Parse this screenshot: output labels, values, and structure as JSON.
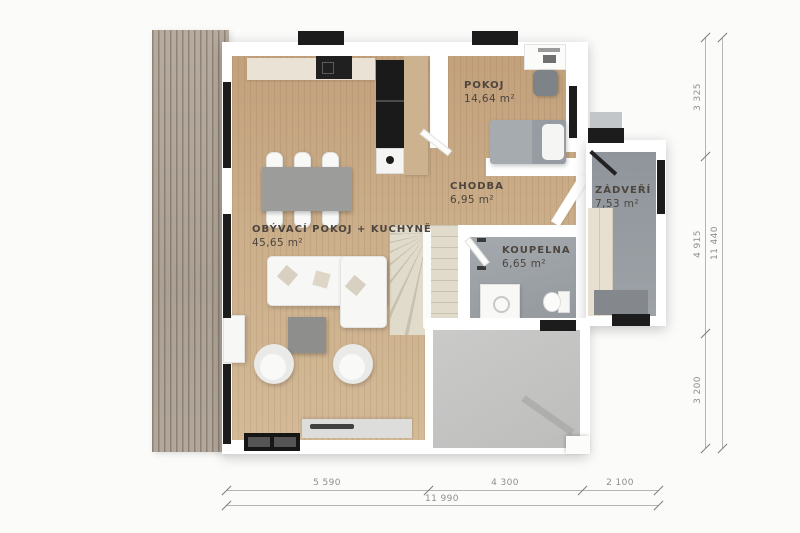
{
  "title": "House ground floor plan",
  "rooms": {
    "pokoj": {
      "name": "POKOJ",
      "area": "14,64 m²"
    },
    "chodba": {
      "name": "CHODBA",
      "area": "6,95 m²"
    },
    "zadveri": {
      "name": "ZÁDVEŘÍ",
      "area": "7,53 m²"
    },
    "koupelna": {
      "name": "KOUPELNA",
      "area": "6,65 m²"
    },
    "obyvaci": {
      "name": "OBÝVACÍ POKOJ + KUCHYNĚ",
      "area": "45,65 m²"
    }
  },
  "dimensions": {
    "right_vertical": {
      "segments": [
        "3 325",
        "4 915",
        "3 200"
      ],
      "total": "11 440"
    },
    "bottom_horizontal": {
      "segments": [
        "5 590",
        "4 300",
        "2 100"
      ],
      "total": "11 990"
    }
  },
  "colors": {
    "wood_floor": "#c9ab85",
    "deck_wood": "#afa497",
    "tile_gray": "#9aa0a5",
    "patio_concrete": "#c4c4c3",
    "wall_white": "#ffffff",
    "window_black": "#1c1c1c",
    "label_text": "#4d453e",
    "dimension_text": "#8e8e8d"
  }
}
